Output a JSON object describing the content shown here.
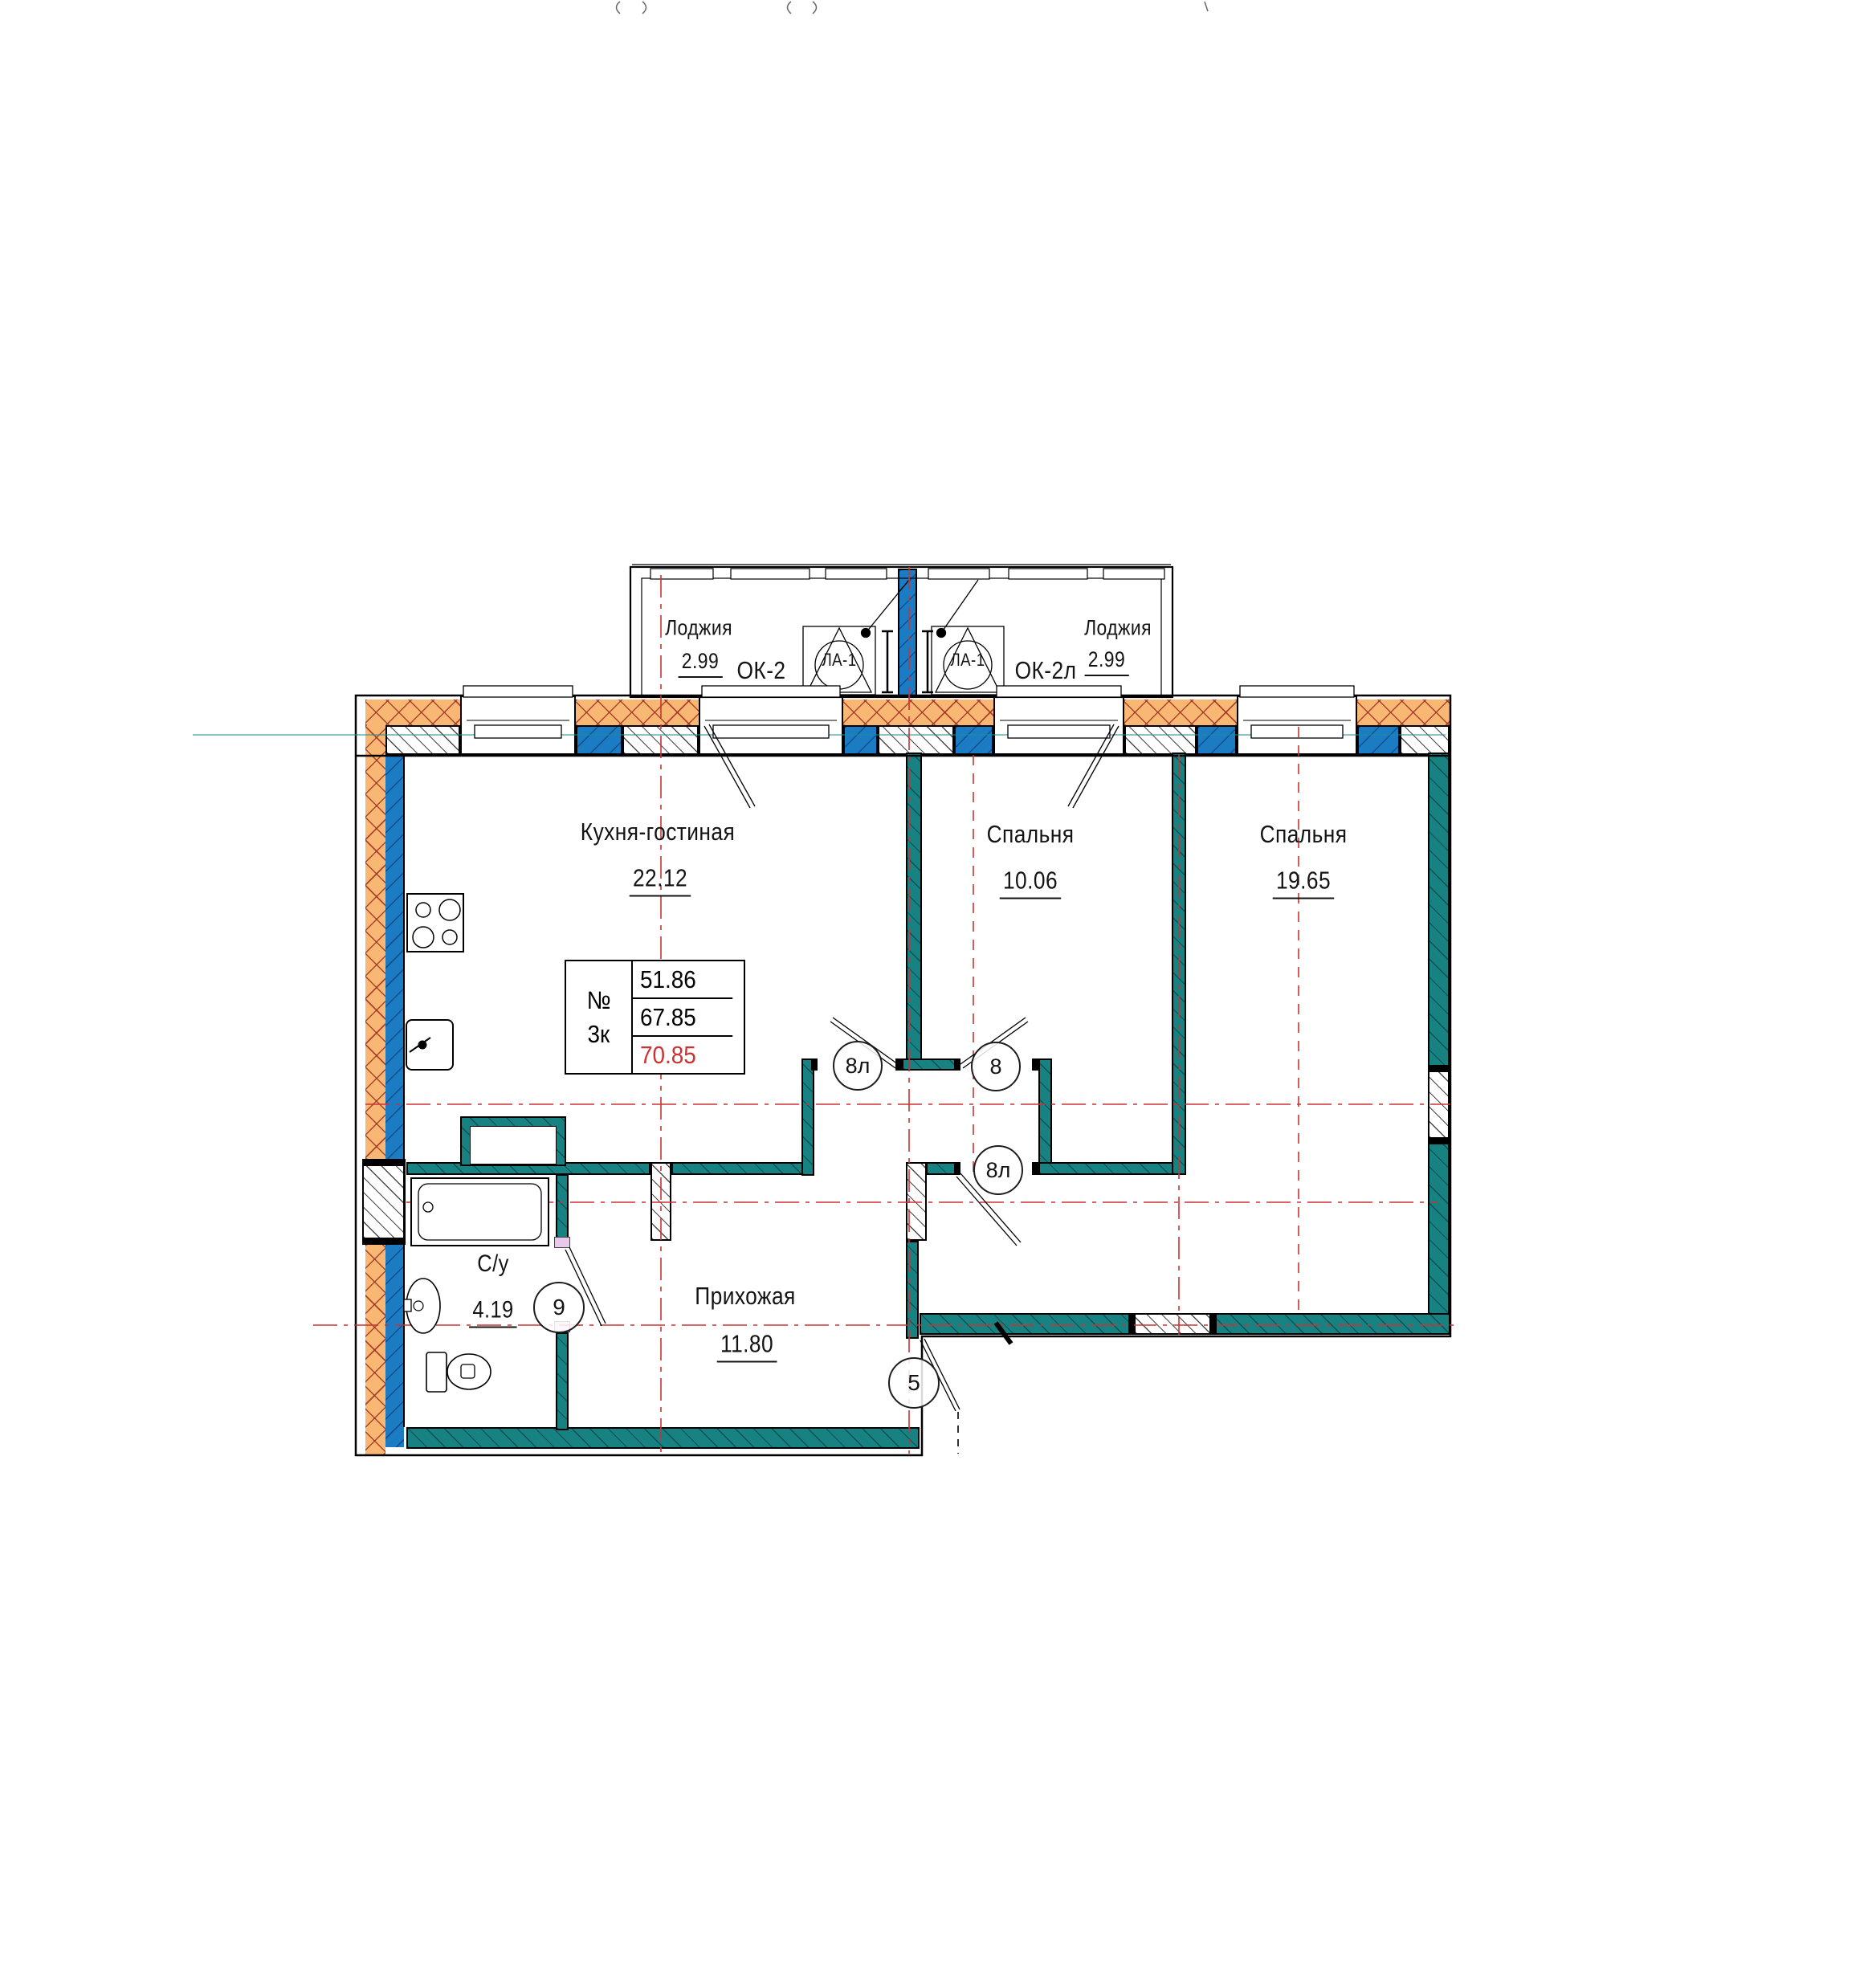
{
  "drawing": {
    "loggia_left": {
      "label": "Лоджия",
      "area": "2.99",
      "window_mark": "ОК-2",
      "louver_mark": "ЛА-1"
    },
    "loggia_right": {
      "label": "Лоджия",
      "area": "2.99",
      "window_mark": "ОК-2л",
      "louver_mark": "ЛА-1"
    },
    "rooms": {
      "kitchen_living": {
        "label": "Кухня-гостиная",
        "area": "22.12"
      },
      "bedroom_1": {
        "label": "Спальня",
        "area": "10.06"
      },
      "bedroom_2": {
        "label": "Спальня",
        "area": "19.65"
      },
      "bathroom": {
        "label": "С/у",
        "area": "4.19"
      },
      "hallway": {
        "label": "Прихожая",
        "area": "11.80"
      }
    },
    "stamp_table": {
      "number_label": "№",
      "apartment_type": "3к",
      "living_area": "51.86",
      "apartment_area": "67.85",
      "total_area": "70.85"
    },
    "door_marks": {
      "kitchen_corridor": "8л",
      "bedroom_1_door": "8",
      "bedroom_2_door": "8л",
      "bathroom_door": "9",
      "entrance_door": "5"
    },
    "colors": {
      "wall_fill": "#188181",
      "masonry_fill": "#1b7cc4",
      "insulation_fill": "#f8b873",
      "axis_line": "#cc3333",
      "total_area_text": "#cc3333"
    }
  }
}
